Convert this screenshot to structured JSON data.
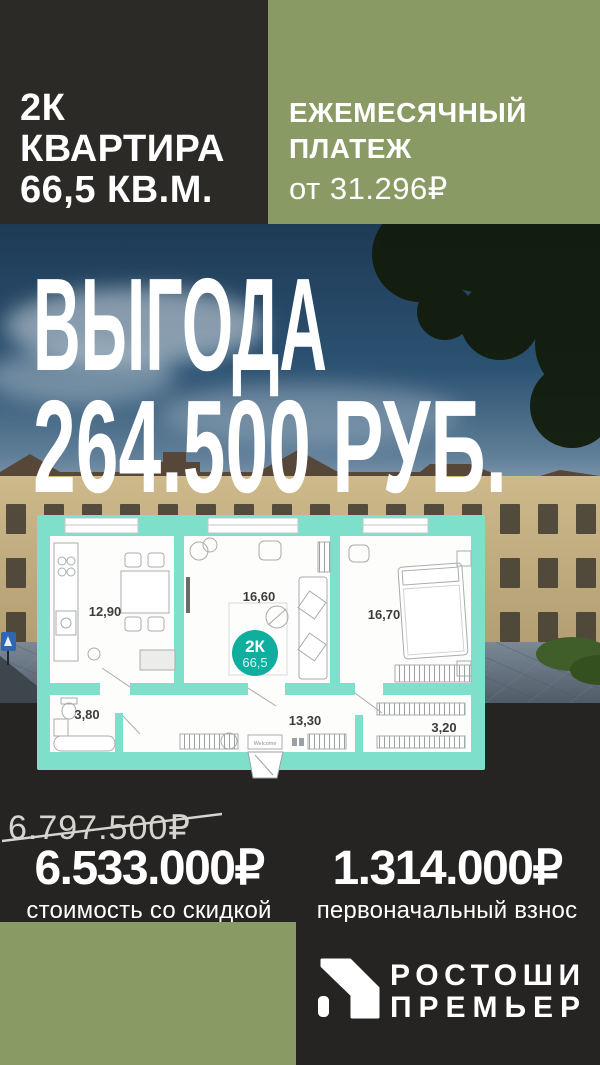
{
  "unit": {
    "rooms_label": "2К",
    "type_label": "КВАРТИРА",
    "area_label": "66,5 КВ.М."
  },
  "payment": {
    "title_line1": "ЕЖЕМЕСЯЧНЫЙ",
    "title_line2": "ПЛАТЕЖ",
    "value": "от 31.296₽"
  },
  "benefit": {
    "line1": "ВЫГОДА",
    "line2": "264.500 РУБ."
  },
  "plan": {
    "kitchen_area": "12,90",
    "living_area": "16,60",
    "bedroom_area": "16,70",
    "bathroom_area": "3,80",
    "hallway_area": "13,30",
    "wardrobe_area": "3,20",
    "badge_type": "2К",
    "badge_area": "66,5",
    "doormat": "Welcome"
  },
  "pricing": {
    "old_price": "6.797.500₽",
    "discount_price": "6.533.000₽",
    "discount_label": "стоимость со скидкой",
    "down_payment": "1.314.000₽",
    "down_payment_label": "первоначальный взнос"
  },
  "brand": {
    "line1": "РОСТОШИ",
    "line2": "ПРЕМЬЕР"
  },
  "colors": {
    "olive": "#8a9a64",
    "dark_header": "#2b2a27",
    "dark_lower": "#262422",
    "plan_teal": "#7ee0ca",
    "badge_teal": "#0fae9f"
  }
}
